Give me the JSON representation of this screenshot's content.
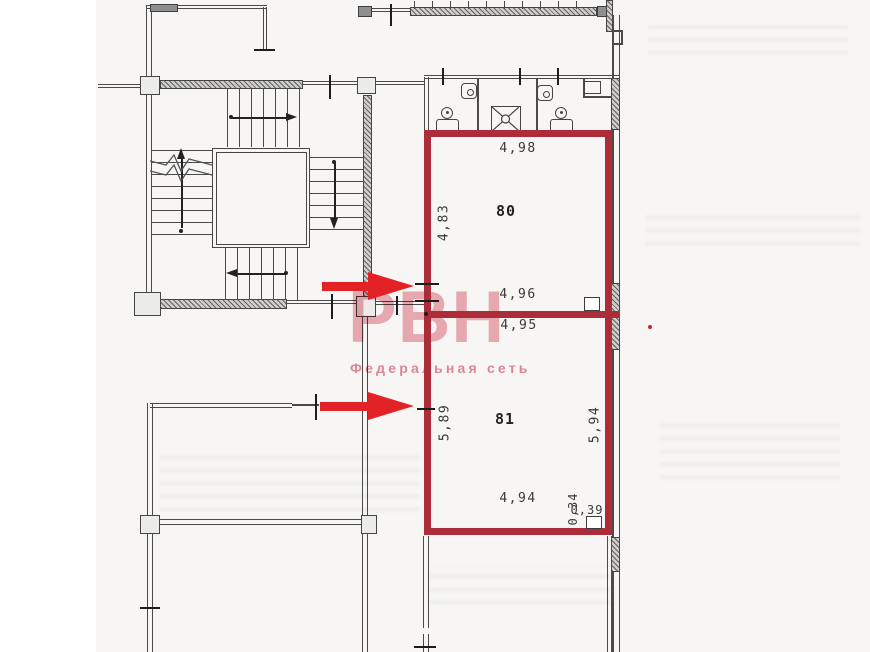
{
  "plan": {
    "watermark": {
      "logo": "РВН",
      "tagline": "Федеральная сеть"
    },
    "rooms": [
      {
        "number": "80",
        "dims": {
          "top": "4,98",
          "left": "4,83",
          "bottom": "4,96"
        }
      },
      {
        "number": "81",
        "dims": {
          "top": "4,95",
          "left": "5,89",
          "right": "5,94",
          "bottom": "4,94",
          "corner_depth": "0,34",
          "corner_width": "0,39"
        }
      }
    ],
    "colors": {
      "room_outline_red": "#ac2d39",
      "arrow_red": "#e32227",
      "watermark_pink": "#ef97a3",
      "wall_gray": "#4a4a4a"
    }
  }
}
